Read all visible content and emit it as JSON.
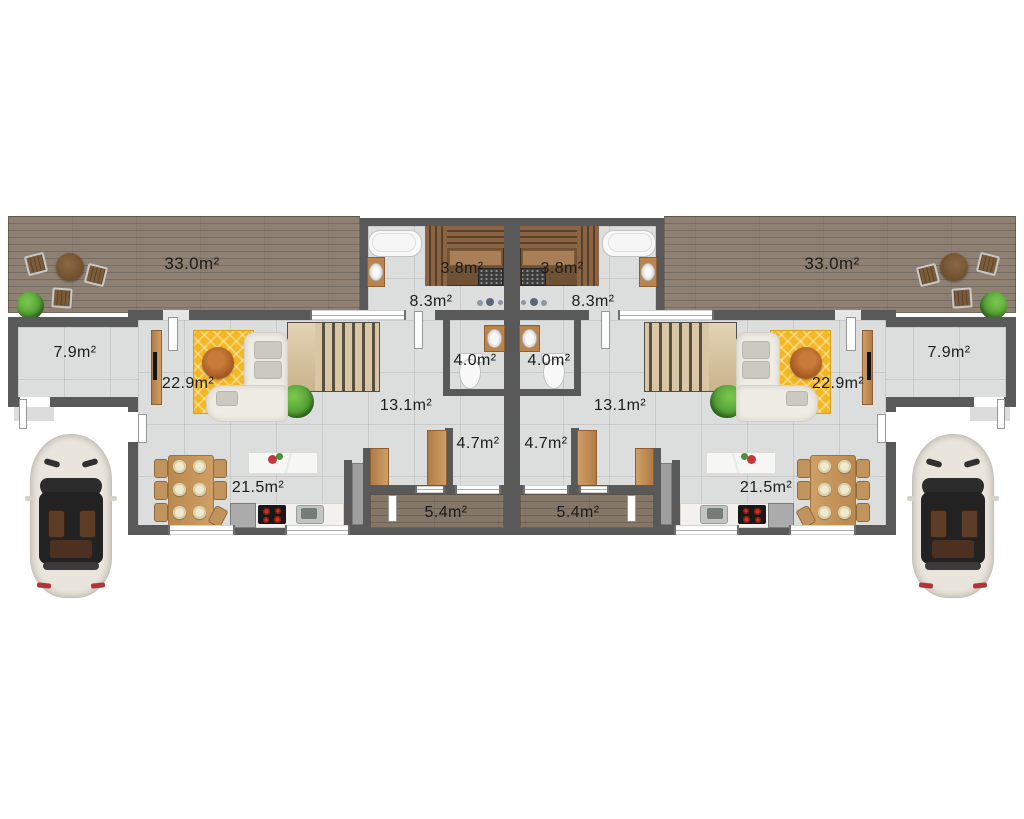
{
  "plan": {
    "type": "residential duplex ground floor plan",
    "units": {
      "left": {
        "terrace": "33.0m²",
        "storage": "7.9m²",
        "living_room": "22.9m²",
        "sauna": "3.8m²",
        "bathroom": "8.3m²",
        "wc": "4.0m²",
        "hallway": "13.1m²",
        "entry": "4.7m²",
        "porch": "5.4m²",
        "kitchen_dining": "21.5m²"
      },
      "right": {
        "terrace": "33.0m²",
        "storage": "7.9m²",
        "living_room": "22.9m²",
        "sauna": "3.8m²",
        "bathroom": "8.3m²",
        "wc": "4.0m²",
        "hallway": "13.1m²",
        "entry": "4.7m²",
        "porch": "5.4m²",
        "kitchen_dining": "21.5m²"
      }
    }
  },
  "colors": {
    "wall": "#595959",
    "floor": "#dcdddd",
    "deck": "#8e8174",
    "porch": "#847768",
    "rug": "#f3b723",
    "wood": "#c1935d",
    "vanity": "#b9854e",
    "sauna": "#6f5134",
    "island": "#f4f4f1",
    "counter": "#f2f1ee",
    "plant": "#4f9c33",
    "car": "#eae5dc",
    "text": "#1c1c1c"
  }
}
